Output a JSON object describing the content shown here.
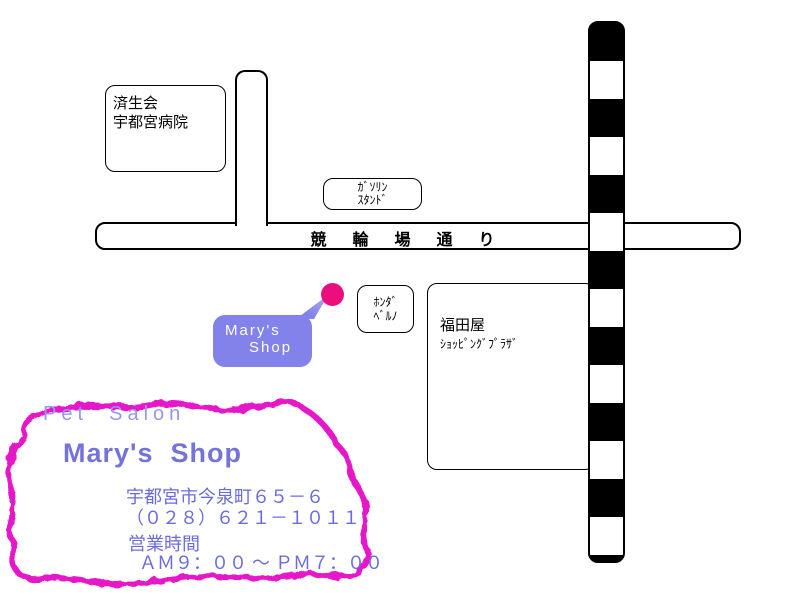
{
  "map": {
    "hospital": {
      "line1": "済生会",
      "line2": "宇都宮病院"
    },
    "gas_station": {
      "line1": "ｶﾞｿﾘﾝ",
      "line2": "ｽﾀﾝﾄﾞ"
    },
    "road_label": "競　輪　場　通　り",
    "honda": {
      "line1": "ﾎﾝﾀﾞ",
      "line2": "ﾍﾞﾙﾉ"
    },
    "fukudaya": {
      "line1": "福田屋",
      "line2": "ｼｮｯﾋﾟﾝｸﾞﾌﾟﾗｻﾞ"
    },
    "shop_callout": {
      "line1": "Mary's",
      "line2": "Shop"
    }
  },
  "info": {
    "category": "Pet  Salon",
    "shop_name": "Mary's  Shop",
    "address": "宇都宮市今泉町６５－６",
    "phone": "（０２８）６２１－１０１１",
    "hours_label": "営業時間",
    "hours": "ＡＭ９：００ ～ ＰＭ７：００"
  },
  "colors": {
    "marker_pink": "#ed0e7e",
    "callout_purple": "#8282ea",
    "callout_pointer_tip": "#b3aaf5",
    "squiggle_magenta": "#e619c9",
    "category_text": "#9797ed",
    "title_text": "#7373db",
    "detail_text": "#6b6bdf",
    "map_line": "#000000"
  }
}
